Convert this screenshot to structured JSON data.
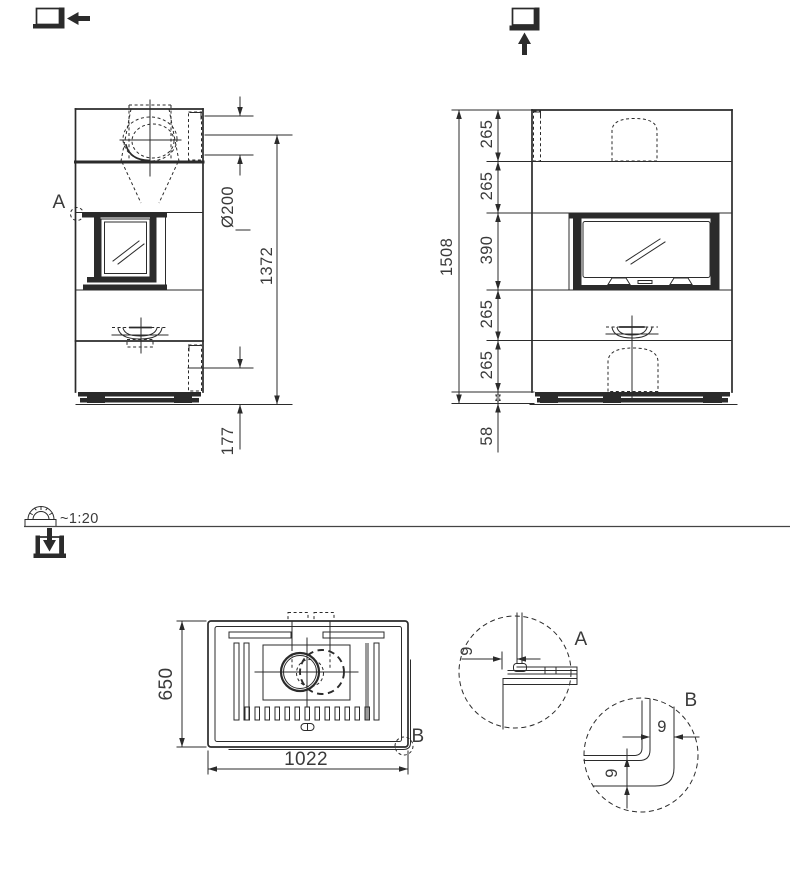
{
  "colors": {
    "ink": "#2b2b2b",
    "text": "#3a3a3a",
    "muted": "#9a9a9a",
    "bg": "#ffffff"
  },
  "scale": {
    "text": "~1:20"
  },
  "icons": {
    "side_view_icon": "square-thick-edge-arrow-left",
    "front_view_icon": "square-thick-edge-arrow-up",
    "plan_view_icon": "square-thick-edge-arrow-down",
    "scale_icon": "protractor-on-ruler"
  },
  "side_view": {
    "label": "A",
    "dims": {
      "flue_diameter": "Ø200",
      "height_to_flue_center": "1372",
      "plinth_height": "177"
    }
  },
  "front_view": {
    "segments": [
      "265",
      "265",
      "390",
      "265",
      "265"
    ],
    "dims": {
      "overall_height": "1508",
      "base_height": "58"
    }
  },
  "top_view": {
    "label": "B",
    "dims": {
      "depth": "650",
      "width": "1022"
    }
  },
  "detail_a": {
    "label": "A",
    "gap": "9"
  },
  "detail_b": {
    "label": "B",
    "gap_horizontal": "9",
    "gap_vertical": "9"
  }
}
